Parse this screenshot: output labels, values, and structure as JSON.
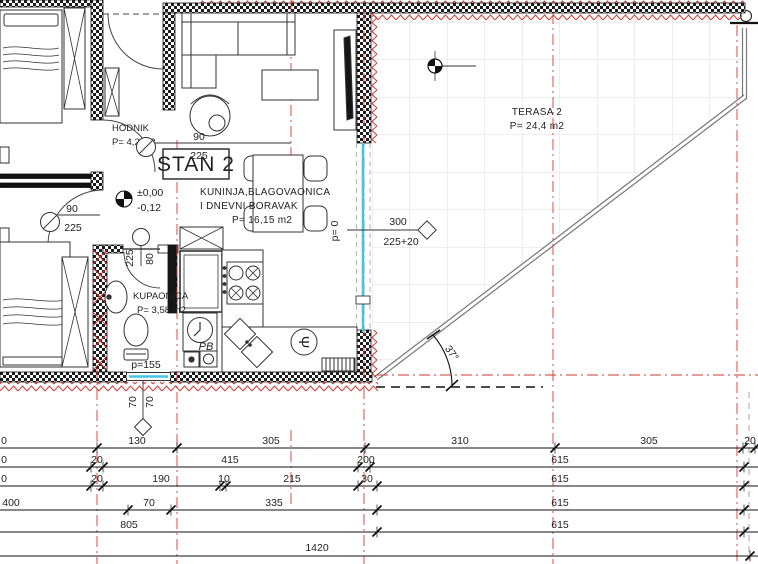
{
  "rooms": {
    "hodnik": {
      "name": "HODNIK",
      "area": "P= 4,2 m2"
    },
    "stan": {
      "label": "STAN 2"
    },
    "living": {
      "line1": "KUNINJA,BLAGOVAONICA",
      "line2": "I DNEVNI BORAVAK",
      "area": "P= 16,15 m2"
    },
    "terasa": {
      "name": "TERASA 2",
      "area": "P= 24,4 m2"
    },
    "kupaonica": {
      "name": "KUPAONICA",
      "area": "P= 3,58 m2"
    }
  },
  "marks": {
    "elevation": {
      "top": "±0,00",
      "bottom": "-0,12"
    },
    "door_upper": {
      "w": "90",
      "h": "225"
    },
    "door_lower": {
      "w": "90",
      "h": "225"
    },
    "door_bath": {
      "h": "225",
      "w": "80"
    },
    "terrace_door": {
      "p": "p= 0",
      "width": "300",
      "height": "225+20"
    },
    "bath_window": {
      "p": "p=155",
      "left": "70",
      "right": "70"
    },
    "angle": "37°",
    "washer": "PB",
    "sink_glyph": "Ψ"
  },
  "dims": {
    "row1": [
      "0",
      "130",
      "305",
      "310",
      "305",
      "20"
    ],
    "row2": [
      "0",
      "20",
      "415",
      "200",
      "615"
    ],
    "row3": [
      "0",
      "20",
      "190",
      "10",
      "215",
      "30",
      "615"
    ],
    "row4": [
      "400",
      "70",
      "335",
      "615"
    ],
    "row5": [
      "805",
      "615"
    ],
    "row6": [
      "1420"
    ]
  },
  "colors": {
    "axis_red": "#d23a32",
    "window_cyan": "#45c6e6",
    "wall_black": "#1c1c1c",
    "tile_grey": "#dcdcdc"
  }
}
